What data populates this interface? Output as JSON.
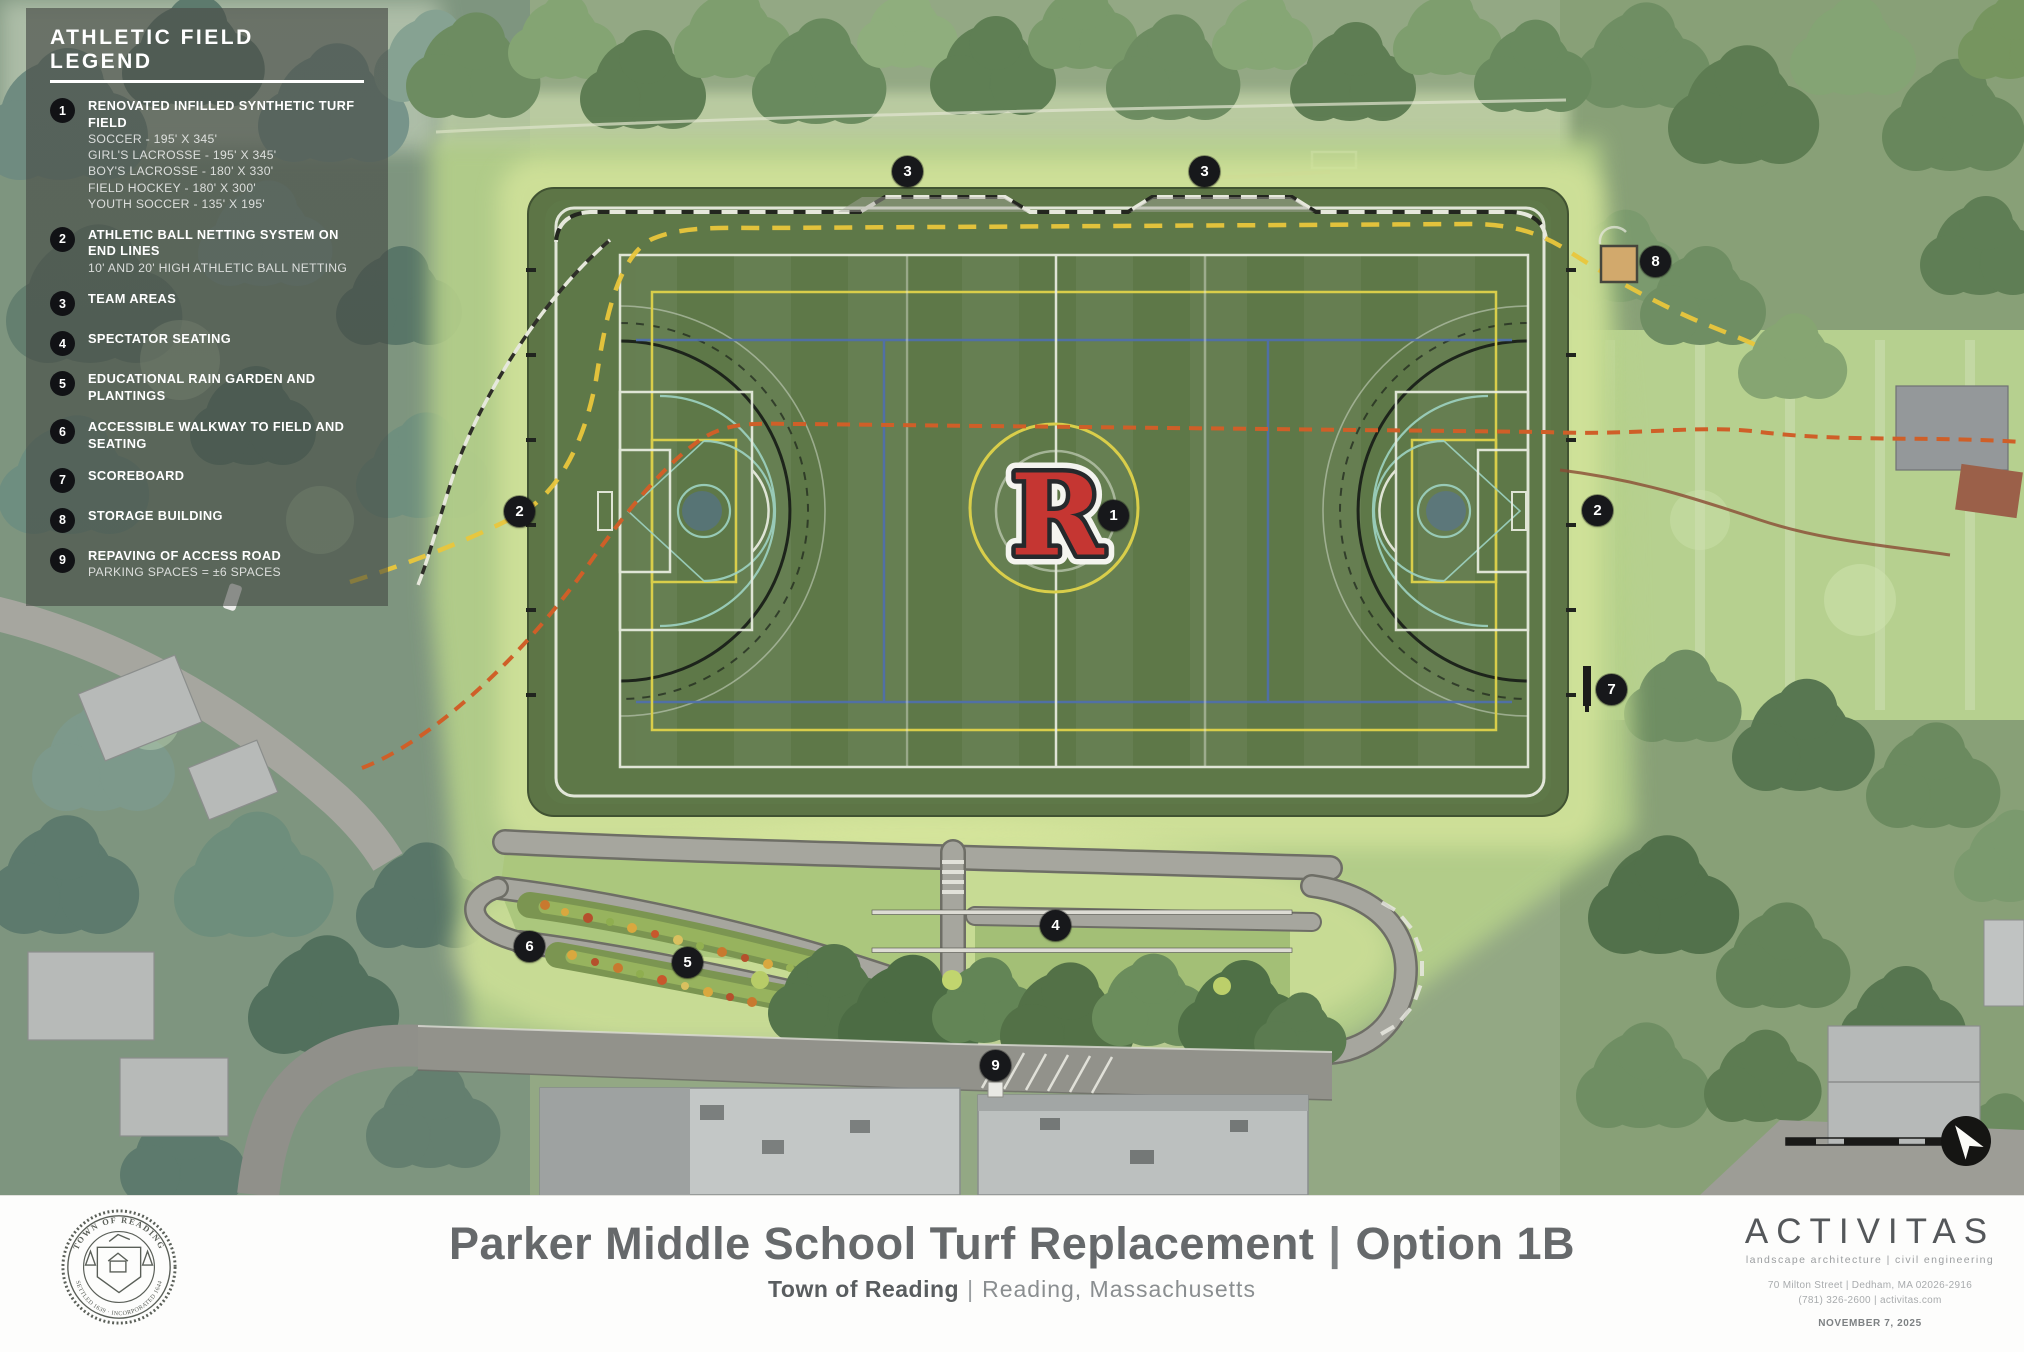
{
  "legend": {
    "title": "ATHLETIC FIELD LEGEND",
    "items": [
      {
        "num": "1",
        "title": "RENOVATED INFILLED SYNTHETIC TURF FIELD",
        "lines": [
          "SOCCER - 195' X 345'",
          "GIRL'S LACROSSE - 195' X 345'",
          "BOY'S LACROSSE - 180' X 330'",
          "FIELD HOCKEY - 180' X 300'",
          "YOUTH SOCCER - 135' X 195'"
        ]
      },
      {
        "num": "2",
        "title": "ATHLETIC BALL NETTING SYSTEM ON END LINES",
        "lines": [
          "10' AND 20' HIGH ATHLETIC BALL NETTING"
        ]
      },
      {
        "num": "3",
        "title": "TEAM AREAS",
        "lines": []
      },
      {
        "num": "4",
        "title": "SPECTATOR SEATING",
        "lines": []
      },
      {
        "num": "5",
        "title": "EDUCATIONAL RAIN GARDEN AND PLANTINGS",
        "lines": []
      },
      {
        "num": "6",
        "title": "ACCESSIBLE WALKWAY TO FIELD AND SEATING",
        "lines": []
      },
      {
        "num": "7",
        "title": "SCOREBOARD",
        "lines": []
      },
      {
        "num": "8",
        "title": "STORAGE BUILDING",
        "lines": []
      },
      {
        "num": "9",
        "title": "REPAVING OF ACCESS ROAD",
        "lines": [
          "PARKING SPACES = ±6 SPACES"
        ]
      }
    ]
  },
  "markers": [
    {
      "num": "1",
      "x": 1114,
      "y": 516
    },
    {
      "num": "2",
      "x": 520,
      "y": 512
    },
    {
      "num": "2",
      "x": 1598,
      "y": 511
    },
    {
      "num": "3",
      "x": 908,
      "y": 172
    },
    {
      "num": "3",
      "x": 1205,
      "y": 172
    },
    {
      "num": "4",
      "x": 1056,
      "y": 926
    },
    {
      "num": "5",
      "x": 688,
      "y": 963
    },
    {
      "num": "6",
      "x": 530,
      "y": 947
    },
    {
      "num": "7",
      "x": 1612,
      "y": 690
    },
    {
      "num": "8",
      "x": 1656,
      "y": 262
    },
    {
      "num": "9",
      "x": 996,
      "y": 1066
    }
  ],
  "field": {
    "logo": "R"
  },
  "titleblock": {
    "title": "Parker Middle School Turf Replacement",
    "separator": "|",
    "option": "Option 1B",
    "subtitle_bold": "Town of Reading",
    "subtitle_separator": "|",
    "subtitle_rest": "Reading, Massachusetts"
  },
  "seal": {
    "top": "TOWN OF READING",
    "bottom": "SETTLED 1639 · INCORPORATED 1644"
  },
  "firm": {
    "name": "ACTIVITAS",
    "tagline": "landscape architecture | civil engineering",
    "address": "70 Milton Street | Dedham, MA 02026-2916",
    "phone_web": "(781) 326-2600 | activitas.com",
    "date": "NOVEMBER 7, 2025"
  },
  "colors": {
    "turf_green": "#5e7848",
    "apron_green": "#5b7345",
    "lawn_green": "#b5d08a",
    "marker_black": "#17181b",
    "logo_red": "#c53632",
    "netting_yellow": "#e9c63c",
    "utility_orange": "#cf5f28",
    "line_blue": "#4f6fae",
    "line_teal": "#9ed3c2",
    "line_yellow": "#d9ce4a",
    "walk_gray": "#a6a69e"
  }
}
